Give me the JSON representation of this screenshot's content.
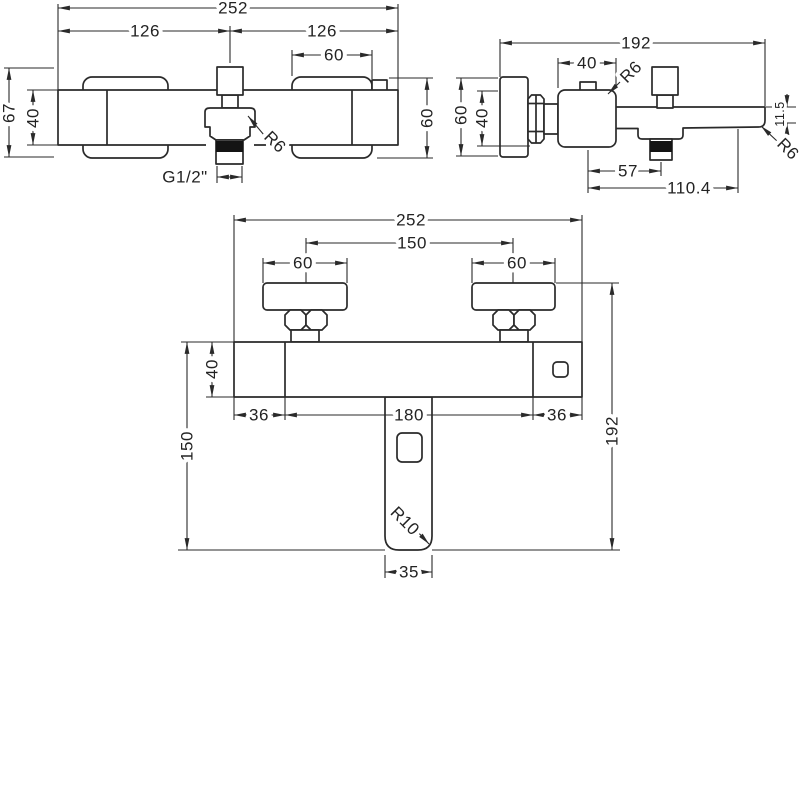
{
  "drawing": {
    "type": "technical-dimension-drawing",
    "subject": "wall-mounted bath shower mixer tap, three orthographic views",
    "line_color": "#2a2a2a",
    "background": "#ffffff",
    "views": {
      "top": {
        "dims": {
          "overall_width": "252",
          "left_center": "126",
          "right_center": "126",
          "handle_width": "60",
          "overall_depth": "67",
          "body_depth": "40",
          "handle_depth": "60",
          "outlet_thread": "G1/2\"",
          "outlet_radius": "R6"
        }
      },
      "side": {
        "dims": {
          "overall_length": "192",
          "handle_size": "40",
          "handle_radius": "R6",
          "flange_size": "60",
          "body_size": "40",
          "outlet_offset": "57",
          "spout_reach": "110.4",
          "tip_height": "11.5",
          "tip_radius": "R6"
        }
      },
      "front": {
        "dims": {
          "overall_width": "252",
          "handle_centers": "150",
          "left_handle_width": "60",
          "right_handle_width": "60",
          "body_height": "40",
          "left_inset": "36",
          "center_span": "180",
          "right_inset": "36",
          "overall_height": "192",
          "body_to_tip": "150",
          "spout_radius": "R10",
          "spout_width": "35"
        }
      }
    }
  }
}
